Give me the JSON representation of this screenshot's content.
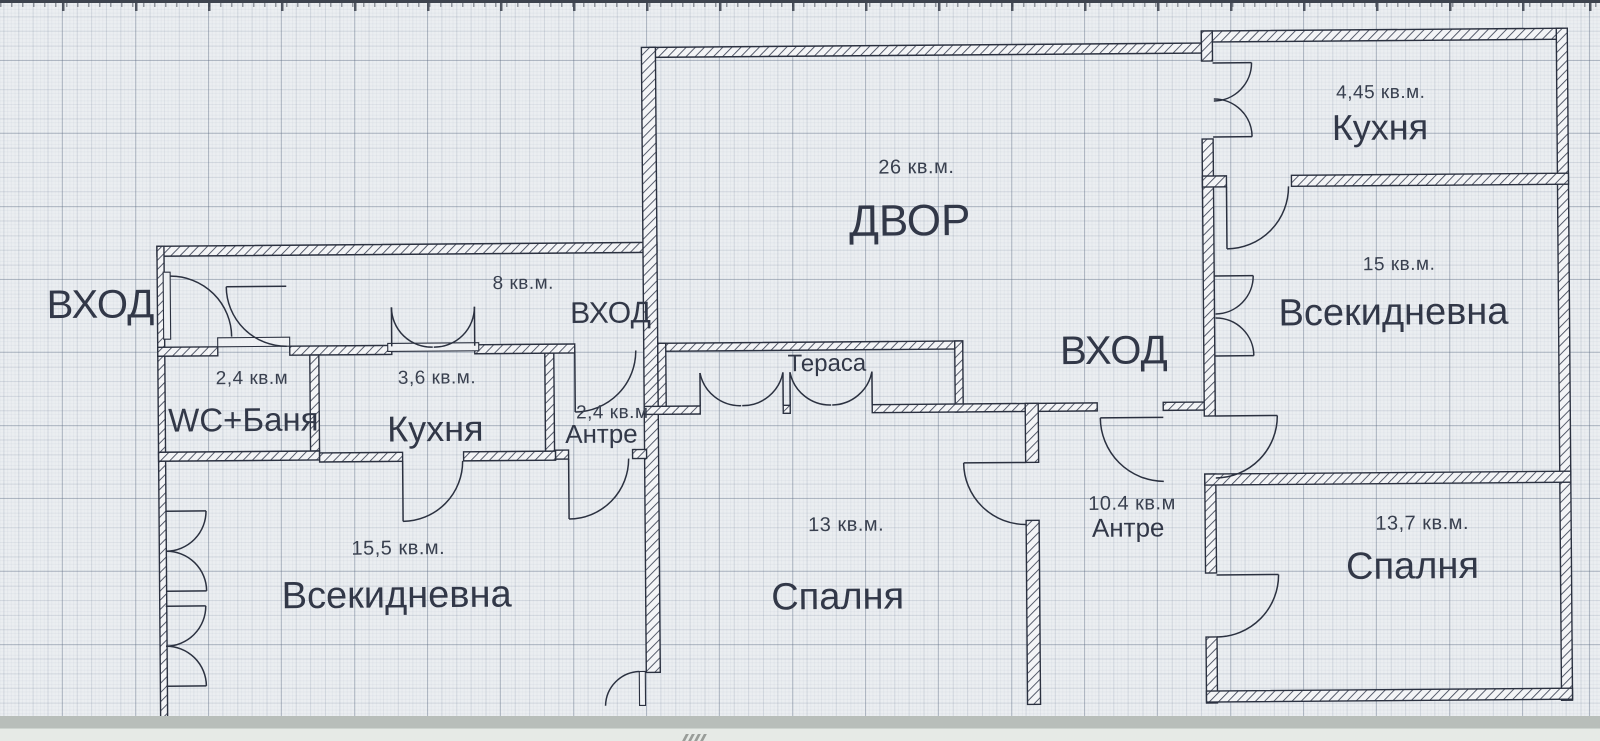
{
  "meta": {
    "type": "floor-plan",
    "language": "bg"
  },
  "palette": {
    "paper": "#ebeef1",
    "ink": "#2b3140",
    "grid_major": "#9fa9b6",
    "grid_minor": "#c3cad3",
    "band_gray": "#b8beba",
    "band_light": "#e6eae6"
  },
  "entrance_labels": [
    {
      "label": "ВХОД"
    },
    {
      "label": "ВХОД"
    },
    {
      "label": "ВХОД"
    }
  ],
  "hallway": {
    "area": "8 кв.м."
  },
  "yard": {
    "name": "ДВОР",
    "area": "26 кв.м."
  },
  "terrace": {
    "name": "Тераса"
  },
  "rooms": [
    {
      "id": "wc-bath",
      "name": "WC+Баня",
      "area": "2,4 кв.м"
    },
    {
      "id": "kitchen-left",
      "name": "Кухня",
      "area": "3,6 кв.м."
    },
    {
      "id": "antre-small",
      "name": "Антре",
      "area": "2,4 кв.м"
    },
    {
      "id": "living-left",
      "name": "Всекидневна",
      "area": "15,5 кв.м."
    },
    {
      "id": "bedroom-middle",
      "name": "Спалня",
      "area": "13 кв.м."
    },
    {
      "id": "antre-right",
      "name": "Антре",
      "area": "10.4 кв.м"
    },
    {
      "id": "kitchen-right",
      "name": "Кухня",
      "area": "4,45 кв.м."
    },
    {
      "id": "living-right",
      "name": "Всекидневна",
      "area": "15 кв.м."
    },
    {
      "id": "bedroom-right",
      "name": "Спалня",
      "area": "13,7 кв.м."
    }
  ]
}
